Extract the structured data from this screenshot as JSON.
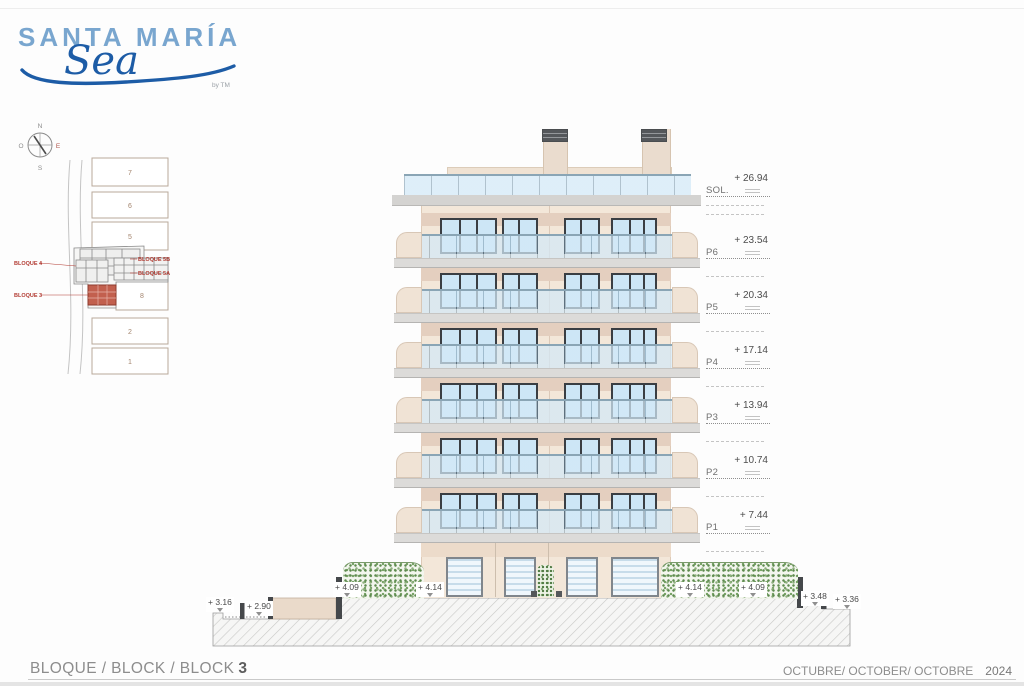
{
  "logo": {
    "brand": "SANTA MARÍA",
    "script": "Sea",
    "byline": "by TM"
  },
  "site_plan": {
    "compass": {
      "north": "N",
      "south": "S",
      "east": "E",
      "west": "O"
    },
    "plots": [
      "7",
      "6",
      "5",
      "2",
      "1",
      "8"
    ],
    "block_labels": [
      "BLOQUE 4",
      "BLOQUE 3",
      "BLOQUE 5B",
      "BLOQUE 5A"
    ]
  },
  "elevation": {
    "levels": [
      {
        "name": "SOL.",
        "value": "+ 26.94"
      },
      {
        "name": "P6",
        "value": "+ 23.54"
      },
      {
        "name": "P5",
        "value": "+ 20.34"
      },
      {
        "name": "P4",
        "value": "+ 17.14"
      },
      {
        "name": "P3",
        "value": "+ 13.94"
      },
      {
        "name": "P2",
        "value": "+ 10.74"
      },
      {
        "name": "P1",
        "value": "+ 7.44"
      }
    ],
    "ground_marks": [
      "+ 3.16",
      "+ 2.90",
      "+ 4.09",
      "+ 4.14",
      "+ 4.14",
      "+ 4.09",
      "+ 3.48",
      "+ 3.36"
    ]
  },
  "footer": {
    "block_title": "BLOQUE / BLOCK / BLOCK",
    "block_number": "3",
    "date": "OCTUBRE/ OCTOBER/ OCTOBRE",
    "year": "2024"
  },
  "colors": {
    "brand_blue": "#79a6cf",
    "script_blue": "#1d5ca6",
    "plan_red": "#b23b32",
    "wall_beige": "#f3e7d9",
    "glass_blue": "#d6ebf8",
    "slab_gray": "#d4d3d1",
    "hedge_green": "#5d8a4e"
  }
}
